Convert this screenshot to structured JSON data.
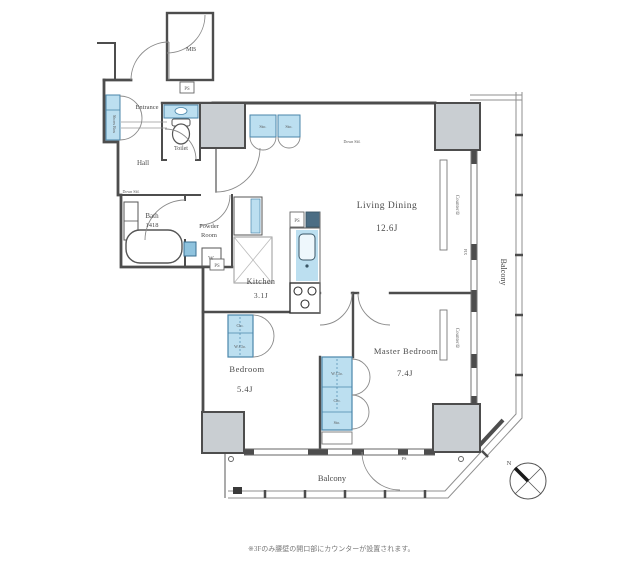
{
  "rooms": {
    "living": {
      "name": "Living Dining",
      "size": "12.6J"
    },
    "master": {
      "name": "Master Bedroom",
      "size": "7.4J"
    },
    "bedroom": {
      "name": "Bedroom",
      "size": "5.4J"
    },
    "kitchen": {
      "name": "Kitchen",
      "size": "3.1J"
    },
    "bath": {
      "name": "Bath",
      "size": "1418"
    },
    "powder": {
      "name_line1": "Powder",
      "name_line2": "Room"
    },
    "toilet": {
      "name": "Toilet"
    },
    "hall": {
      "name": "Hall"
    },
    "entrance": {
      "name": "Entrance"
    },
    "mb": {
      "name": "MB"
    },
    "balcony_right": {
      "name": "Balcony"
    },
    "balcony_bottom": {
      "name": "Balcony"
    }
  },
  "fixtures": {
    "shoes_box": "Shoes Box",
    "storage_1": "Sto.",
    "storage_2": "Sto.",
    "washer": "W",
    "ps_mb": "PS",
    "ps_bath": "PS",
    "ps_kitchen": "PS",
    "ps_wall": "PS",
    "bedroom_closet_top": "Clo.",
    "bedroom_closet_bottom": "W.Clo.",
    "master_closet_top": "W.Clo.",
    "master_closet_mid": "Clo.",
    "master_closet_bottom": "Sto.",
    "counter_living": "Counter①",
    "counter_master": "Counter①",
    "fix_window": "FIX",
    "down_ceiling_1": "Down Sld.",
    "down_ceiling_2": "Down Sld."
  },
  "compass": {
    "north": "N"
  },
  "note": "※3Fのみ腰壁の開口部にカウンターが設置されます。",
  "colors": {
    "wall": "#4d4d4d",
    "fixture_blue": "#bcdff0",
    "fixture_blue_stroke": "#4a86aa",
    "column": "#c9ced2",
    "thin_line": "#8a8a8a"
  }
}
